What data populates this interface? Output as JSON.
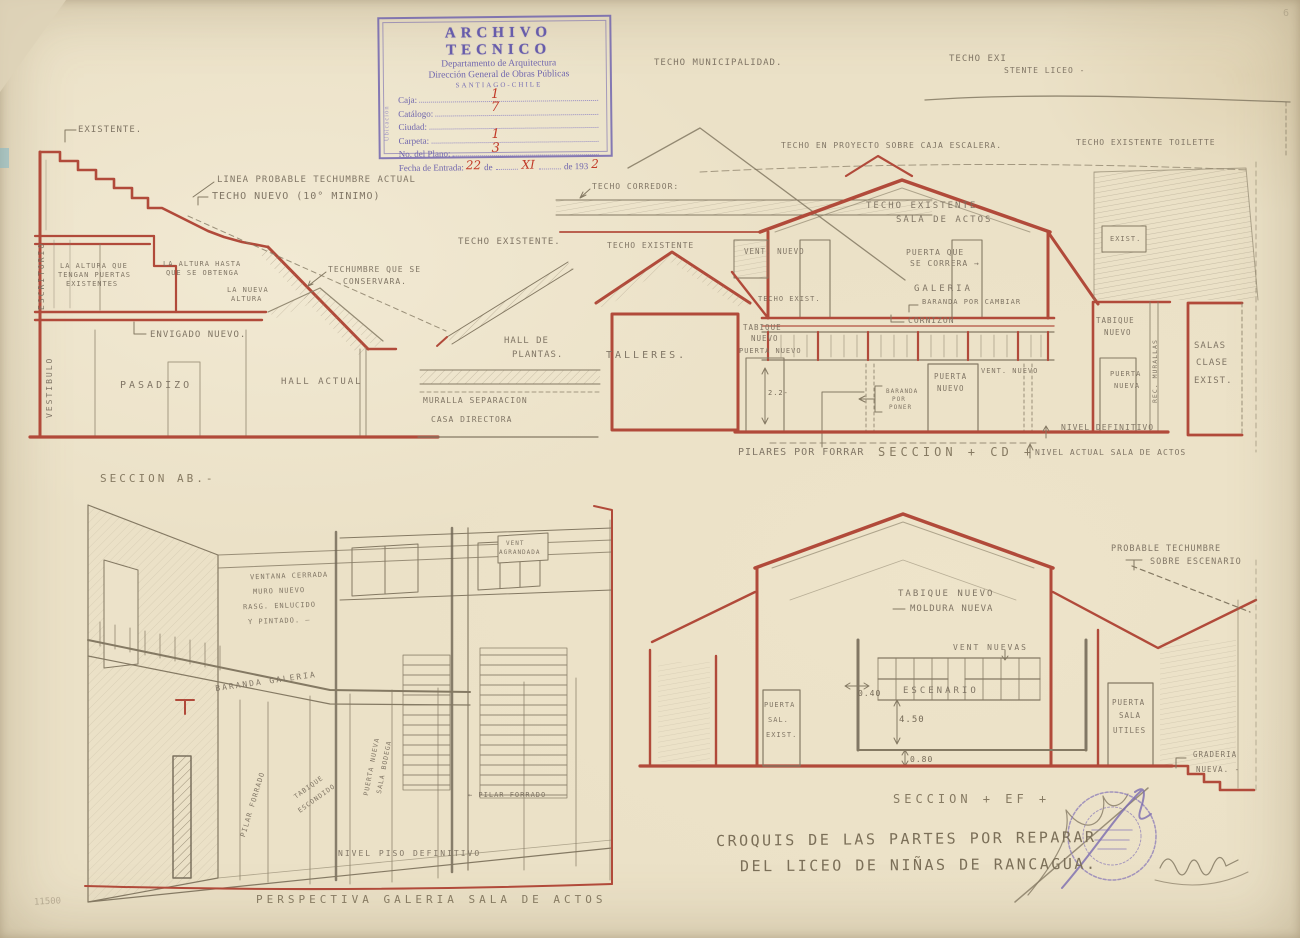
{
  "meta": {
    "document_type": "Croquis escaneado - plano de arquitectura",
    "corner_mark": "6",
    "margin_note": "11500"
  },
  "colors": {
    "paper": "#ebe1c7",
    "red_ink": "#b14a3a",
    "pencil": "#847963",
    "stamp_purple": "#6a5eae",
    "handwritten_red": "#c23a28"
  },
  "stamp": {
    "title": "ARCHIVO TECNICO",
    "dept": "Departamento de Arquitectura",
    "dir": "Dirección General de Obras Públicas",
    "city": "SANTIAGO-CHILE",
    "side": "Ubicación",
    "fields": {
      "caja": {
        "label": "Caja:",
        "value": "1"
      },
      "catalogo": {
        "label": "Catálogo:",
        "value": "7"
      },
      "ciudad": {
        "label": "Ciudad:",
        "value": ""
      },
      "carpeta": {
        "label": "Carpeta:",
        "value": "1"
      },
      "plano": {
        "label": "No. del Plano:",
        "value": "3"
      },
      "fecha": {
        "label": "Fecha de Entrada:",
        "day": "22",
        "de1": "de",
        "month": "XI",
        "de2": "de 193",
        "year": "2"
      }
    }
  },
  "title_block": {
    "line1": "CROQUIS DE LAS PARTES POR REPARAR",
    "line2": "DEL LICEO DE NIÑAS DE RANCAGUA."
  },
  "sections": {
    "ab": {
      "existente": "EXISTENTE.",
      "linea_probable": "LINEA PROBABLE TECHUMBRE ACTUAL",
      "techo_nuevo": "TECHO NUEVO (10° MINIMO)",
      "escritorio": "ESCRITORIO",
      "altura_puertas": [
        "LA ALTURA QUE",
        "TENGAN PUERTAS",
        "EXISTENTES"
      ],
      "altura_hasta": [
        "LA ALTURA HASTA",
        "QUE SE OBTENGA"
      ],
      "nueva_altura": [
        "LA NUEVA",
        "ALTURA"
      ],
      "techumbre_conserva": [
        "TECHUMBRE QUE SE",
        "CONSERVARA."
      ],
      "envigado": "ENVIGADO NUEVO.",
      "vestibulo": "VESTIBULO",
      "pasadizo": "PASADIZO",
      "hall_actual": "HALL ACTUAL",
      "caption": "SECCION AB.-"
    },
    "middle": {
      "techo_existente": "TECHO EXISTENTE.",
      "hall_plantas": [
        "HALL DE",
        "PLANTAS."
      ],
      "muralla": [
        "MURALLA SEPARACION",
        "CASA DIRECTORA"
      ],
      "techo_corredor": "TECHO CORREDOR:",
      "techo_existente_2": "TECHO EXISTENTE",
      "talleres": "TALLERES."
    },
    "cd": {
      "techo_municipalidad": "TECHO MUNICIPALIDAD.",
      "techo_existente_liceo": [
        "TECHO EXI",
        "STENTE  LICEO -"
      ],
      "techo_proyecto": "TECHO EN PROYECTO SOBRE CAJA ESCALERA.",
      "techo_toilette": "TECHO EXISTENTE TOILETTE",
      "techo_sala_actos": [
        "TECHO EXISTENTE",
        "SALA DE ACTOS"
      ],
      "vent_nuevo_izq": "VENT. NUEVO",
      "puerta_correra": [
        "PUERTA QUE",
        "SE CORRERA →"
      ],
      "galeria": "GALERIA",
      "baranda_cambiar": "BARANDA POR CAMBIAR",
      "techo_exist": "TECHO EXIST.",
      "cornizon": "CORNIZON",
      "tabique_nuevo_izq": [
        "TABIQUE",
        "NUEVO"
      ],
      "puerta_nuevo_izq": "PUERTA NUEVO",
      "dim_puerta": "2.2-",
      "baranda_poner": [
        "BARANDA",
        "POR",
        "PONER"
      ],
      "puerta_nueva_centro": [
        "PUERTA",
        "NUEVO"
      ],
      "vent_nuevo_centro": "VENT. NUEVO",
      "tabique_nuevo_der": [
        "TABIQUE",
        "NUEVO"
      ],
      "puerta_nueva_der": [
        "PUERTA",
        "NUEVA"
      ],
      "rec_murallas": "REC. MURALLAS",
      "salas_clase": [
        "SALAS",
        "CLASE",
        "EXIST."
      ],
      "exist_box": "EXIST.",
      "nivel_definitivo": "NIVEL DEFINITIVO",
      "nivel_actual": "NIVEL ACTUAL SALA DE ACTOS",
      "pilares": "PILARES POR FORRAR",
      "caption": "SECCION + CD +"
    },
    "perspective": {
      "vent_agrandada": [
        "VENT",
        "AGRANDADA"
      ],
      "ventana_cerrada": [
        "VENTANA CERRADA",
        "MURO NUEVO",
        "RASG. ENLUCIDO",
        "Y PINTADO. —"
      ],
      "baranda_galeria": "BARANDA GALERIA",
      "pilar_forrado_1": "PILAR FORRADO",
      "tabique_escondido": [
        "TABIQUE",
        "ESCONDIDO"
      ],
      "puerta_bodega": [
        "PUERTA NUEVA",
        "SALA BODEGA"
      ],
      "pilar_forrado_2": "← PILAR FORRADO",
      "nivel_piso": "NIVEL PISO DEFINITIVO",
      "caption": "PERSPECTIVA GALERIA SALA DE ACTOS"
    },
    "ef": {
      "probable_techumbre": [
        "PROBABLE TECHUMBRE",
        "SOBRE ESCENARIO"
      ],
      "tabique_nuevo": "TABIQUE NUEVO",
      "moldura_nueva": "MOLDURA NUEVA",
      "vent_nuevas": "VENT NUEVAS",
      "escenario": "ESCENARIO",
      "dims": {
        "alto_vent": "0.40",
        "alto_escenario": "4.50",
        "alto_piso": "0.80"
      },
      "puerta_sal_exist": [
        "PUERTA",
        "SAL.",
        "EXIST."
      ],
      "puerta_sala_utiles": [
        "PUERTA",
        "SALA",
        "UTILES"
      ],
      "graderia": [
        "GRADERIA",
        "NUEVA. -"
      ],
      "caption": "SECCION + EF +"
    }
  }
}
